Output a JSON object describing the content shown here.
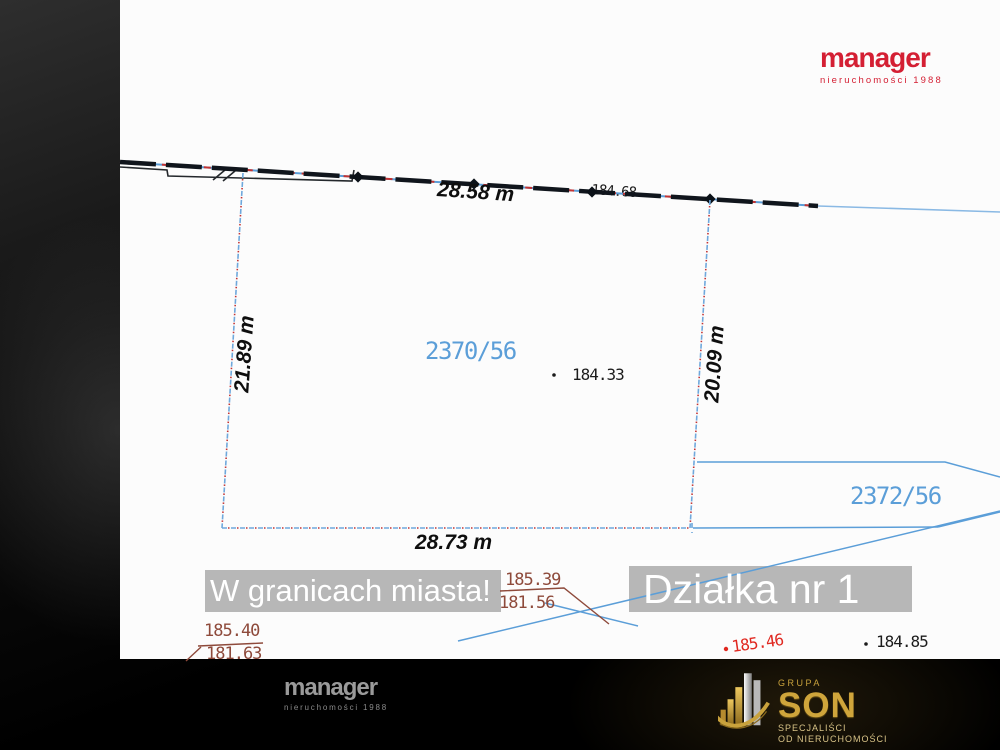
{
  "banners": {
    "city": "W granicach miasta!",
    "plot": "Działka nr 1"
  },
  "parcels": {
    "main": "2370/56",
    "neighbor": "2372/56"
  },
  "dimensions": {
    "top": "28.58 m",
    "bottom": "28.73 m",
    "left": "21.89 m",
    "right": "20.09 m"
  },
  "elevations": {
    "boundary_point": "184.68",
    "center": "184.33",
    "right_black": "184.85",
    "right_red": "185.46",
    "fraction_mid": {
      "upper": "185.39",
      "lower": "181.56"
    },
    "fraction_left": {
      "upper": "185.40",
      "lower": "181.63"
    }
  },
  "logos": {
    "manager_top": {
      "name": "manager",
      "tagline": "nieruchomości 1988"
    },
    "manager_bottom": {
      "name": "manager",
      "tagline": "nieruchomości 1988"
    },
    "son": {
      "group": "GRUPA",
      "name": "SON",
      "line1": "SPECJALIŚCI",
      "line2": "OD NIERUCHOMOŚCI"
    }
  },
  "colors": {
    "cad_blue": "#5b9ed8",
    "dash_red": "#c23333",
    "elev_brown": "#8e4a3b",
    "spot_red": "#e02820",
    "brand_red": "#d41f33",
    "gold": "#cfa53b",
    "banner_gray": "#b7b7b7"
  }
}
